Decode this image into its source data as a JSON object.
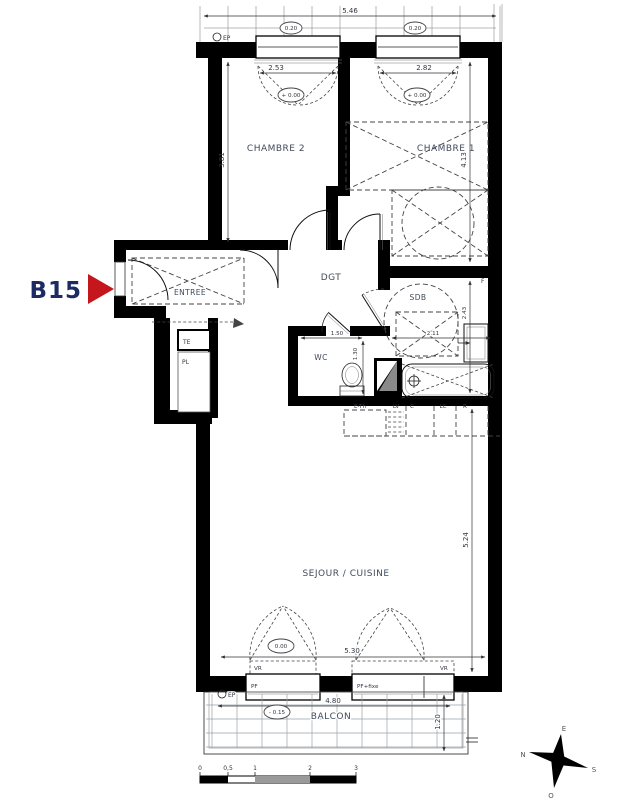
{
  "unit": {
    "label": "B15"
  },
  "rooms": {
    "chambre2": "CHAMBRE 2",
    "chambre1": "CHAMBRE 1",
    "dgt": "DGT",
    "entree": "ENTREE",
    "sdb": "SDB",
    "wc": "WC",
    "sejour": "SEJOUR / CUISINE",
    "balcon": "BALCON",
    "te": "TE",
    "pl": "PL"
  },
  "dims": {
    "total_top": "5.46",
    "window1": "2.53",
    "window2": "2.82",
    "chambre2_depth": "3.81",
    "chambre1_depth": "4.13",
    "wc_width": "1.50",
    "wc_depth": "1.30",
    "sdb_width": "2.11",
    "sdb_depth": "2.43",
    "sejour_width": "5.30",
    "sejour_depth": "5.24",
    "balcon_width": "4.80",
    "balcon_depth": "1.20"
  },
  "levels": {
    "wall_thickness": "0.20",
    "floor_main": "+ 0.00",
    "floor_sejour": "0.00",
    "floor_balcon": "- 0.15"
  },
  "codes": {
    "ep": "EP",
    "f": "F",
    "vr": "VR",
    "pf": "PF",
    "pf_fixe": "PF+fixe"
  },
  "appliances": {
    "evier": "E-Th",
    "lave_vaisselle": "LV",
    "cuisson": "C",
    "lave_linge": "LC",
    "refrigerateur": "R"
  },
  "scalebar": {
    "t0": "0",
    "t05": "0,5",
    "t1": "1",
    "t2": "2",
    "t3": "3"
  },
  "compass": {
    "north": "N",
    "south": "S",
    "east": "E",
    "west": "O"
  },
  "colors": {
    "wall": "#000000",
    "unit_label": "#1d2b63",
    "arrow_red": "#c4161c",
    "room_label": "#3f4a5a"
  }
}
